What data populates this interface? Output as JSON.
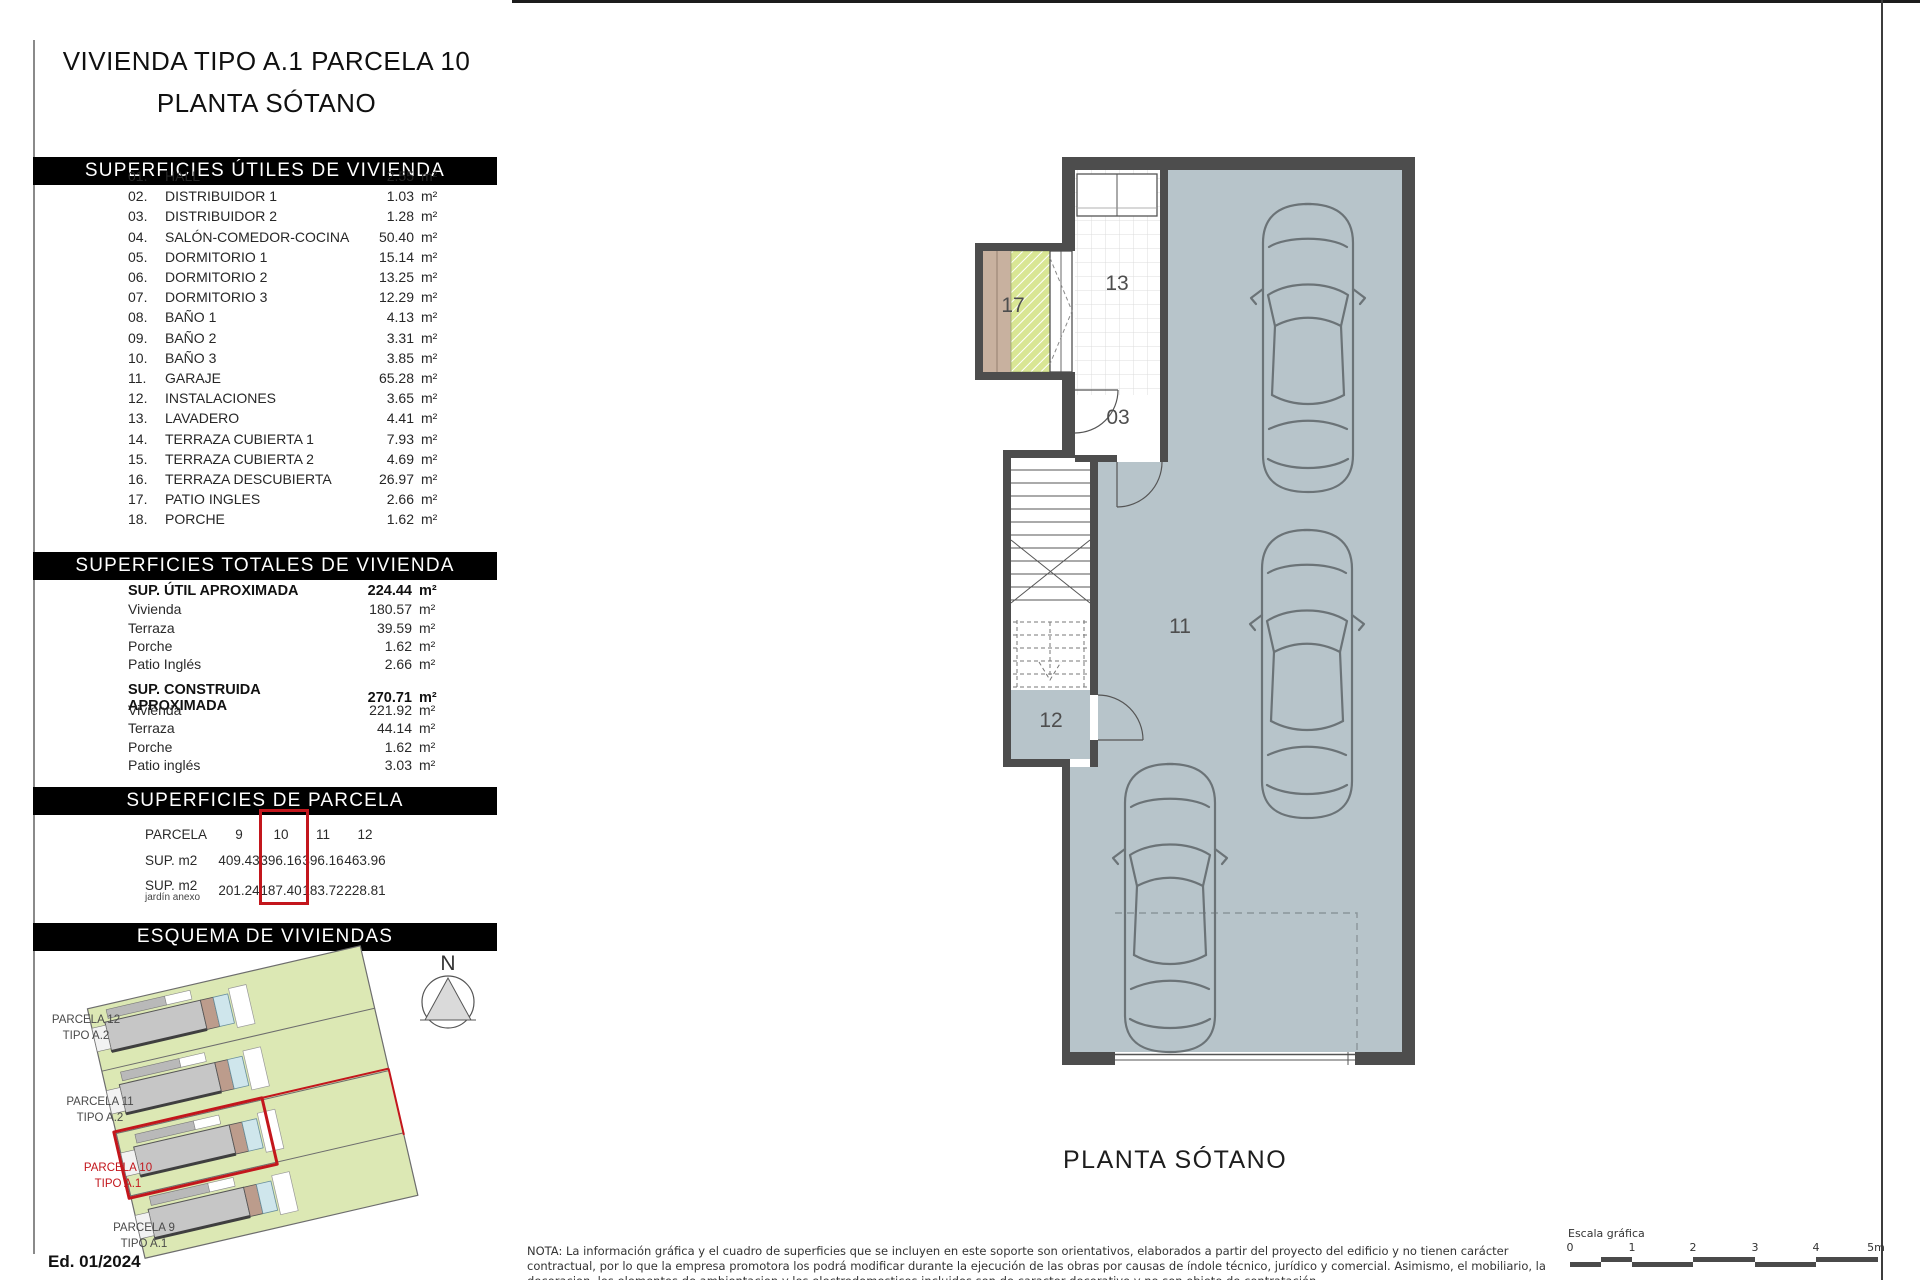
{
  "title": {
    "line1": "VIVIENDA TIPO A.1 PARCELA 10",
    "line2": "PLANTA SÓTANO"
  },
  "units": {
    "m2": "m²"
  },
  "useful": {
    "header": "SUPERFICIES ÚTILES DE VIVIENDA",
    "rows": [
      {
        "n": "01.",
        "l": "HALL",
        "v": "2.55"
      },
      {
        "n": "02.",
        "l": "DISTRIBUIDOR 1",
        "v": "1.03"
      },
      {
        "n": "03.",
        "l": "DISTRIBUIDOR 2",
        "v": "1.28"
      },
      {
        "n": "04.",
        "l": "SALÓN-COMEDOR-COCINA",
        "v": "50.40"
      },
      {
        "n": "05.",
        "l": "DORMITORIO 1",
        "v": "15.14"
      },
      {
        "n": "06.",
        "l": "DORMITORIO 2",
        "v": "13.25"
      },
      {
        "n": "07.",
        "l": "DORMITORIO 3",
        "v": "12.29"
      },
      {
        "n": "08.",
        "l": "BAÑO 1",
        "v": "4.13"
      },
      {
        "n": "09.",
        "l": "BAÑO 2",
        "v": "3.31"
      },
      {
        "n": "10.",
        "l": "BAÑO 3",
        "v": "3.85"
      },
      {
        "n": "11.",
        "l": "GARAJE",
        "v": "65.28"
      },
      {
        "n": "12.",
        "l": "INSTALACIONES",
        "v": "3.65"
      },
      {
        "n": "13.",
        "l": "LAVADERO",
        "v": "4.41"
      },
      {
        "n": "14.",
        "l": "TERRAZA CUBIERTA 1",
        "v": "7.93"
      },
      {
        "n": "15.",
        "l": "TERRAZA CUBIERTA 2",
        "v": "4.69"
      },
      {
        "n": "16.",
        "l": "TERRAZA DESCUBIERTA",
        "v": "26.97"
      },
      {
        "n": "17.",
        "l": "PATIO INGLES",
        "v": "2.66"
      },
      {
        "n": "18.",
        "l": "PORCHE",
        "v": "1.62"
      }
    ]
  },
  "totals": {
    "header": "SUPERFICIES TOTALES DE VIVIENDA",
    "g1": {
      "title": "SUP. ÚTIL APROXIMADA",
      "value": "224.44",
      "rows": [
        {
          "l": "Vivienda",
          "v": "180.57"
        },
        {
          "l": "Terraza",
          "v": "39.59"
        },
        {
          "l": "Porche",
          "v": "1.62"
        },
        {
          "l": "Patio Inglés",
          "v": "2.66"
        }
      ]
    },
    "g2": {
      "title": "SUP. CONSTRUIDA APROXIMADA",
      "value": "270.71",
      "rows": [
        {
          "l": "Vivienda",
          "v": "221.92"
        },
        {
          "l": "Terraza",
          "v": "44.14"
        },
        {
          "l": "Porche",
          "v": "1.62"
        },
        {
          "l": "Patio inglés",
          "v": "3.03"
        }
      ]
    }
  },
  "parcel": {
    "header": "SUPERFICIES DE PARCELA",
    "row1_label": "PARCELA",
    "row2_label": "SUP. m2",
    "row3_label": "SUP. m2",
    "row3_sublabel": "jardín anexo",
    "cols": [
      "9",
      "10",
      "11",
      "12"
    ],
    "sup": [
      "409.43",
      "396.16",
      "396.16",
      "463.96"
    ],
    "jardin": [
      "201.24",
      "187.40",
      "183.72",
      "228.81"
    ],
    "highlighted_col": "10"
  },
  "esquema": {
    "header": "ESQUEMA DE VIVIENDAS",
    "compass": "N",
    "labels": [
      {
        "name": "PARCELA 12",
        "tipo": "TIPO A.2"
      },
      {
        "name": "PARCELA 11",
        "tipo": "TIPO A.2"
      },
      {
        "name": "PARCELA 10",
        "tipo": "TIPO A.1"
      },
      {
        "name": "PARCELA 9",
        "tipo": "TIPO A.1"
      }
    ]
  },
  "floor_plan": {
    "caption": "PLANTA SÓTANO",
    "rooms": [
      "17",
      "13",
      "03",
      "11",
      "12"
    ]
  },
  "footer": {
    "note": "NOTA: La información gráfica y el cuadro de superficies que se incluyen en este soporte son orientativos, elaborados a partir del proyecto del edificio y no tienen carácter contractual, por lo que la empresa promotora los podrá modificar durante la ejecución de las obras por causas de índole técnico, jurídico y comercial. Asimismo, el mobiliario, la decoracion, los elementos de ambientacion y los electrodomesticos incluidos son de caracter decorativo y no son objeto de contratación.",
    "scale_label": "Escala gráfica",
    "scale_ticks": [
      "0",
      "1",
      "2",
      "3",
      "4",
      "5m"
    ]
  },
  "edition": "Ed. 01/2024",
  "colors": {
    "highlight_red": "#c3161c",
    "wall_gray": "#4d4d4d",
    "garage_fill": "#b7c4ca",
    "parcel_green": "#dce8b4",
    "patio_tan": "#c8b19f",
    "hatch_green": "#d9e694",
    "water_blue": "#cfe6ec"
  }
}
